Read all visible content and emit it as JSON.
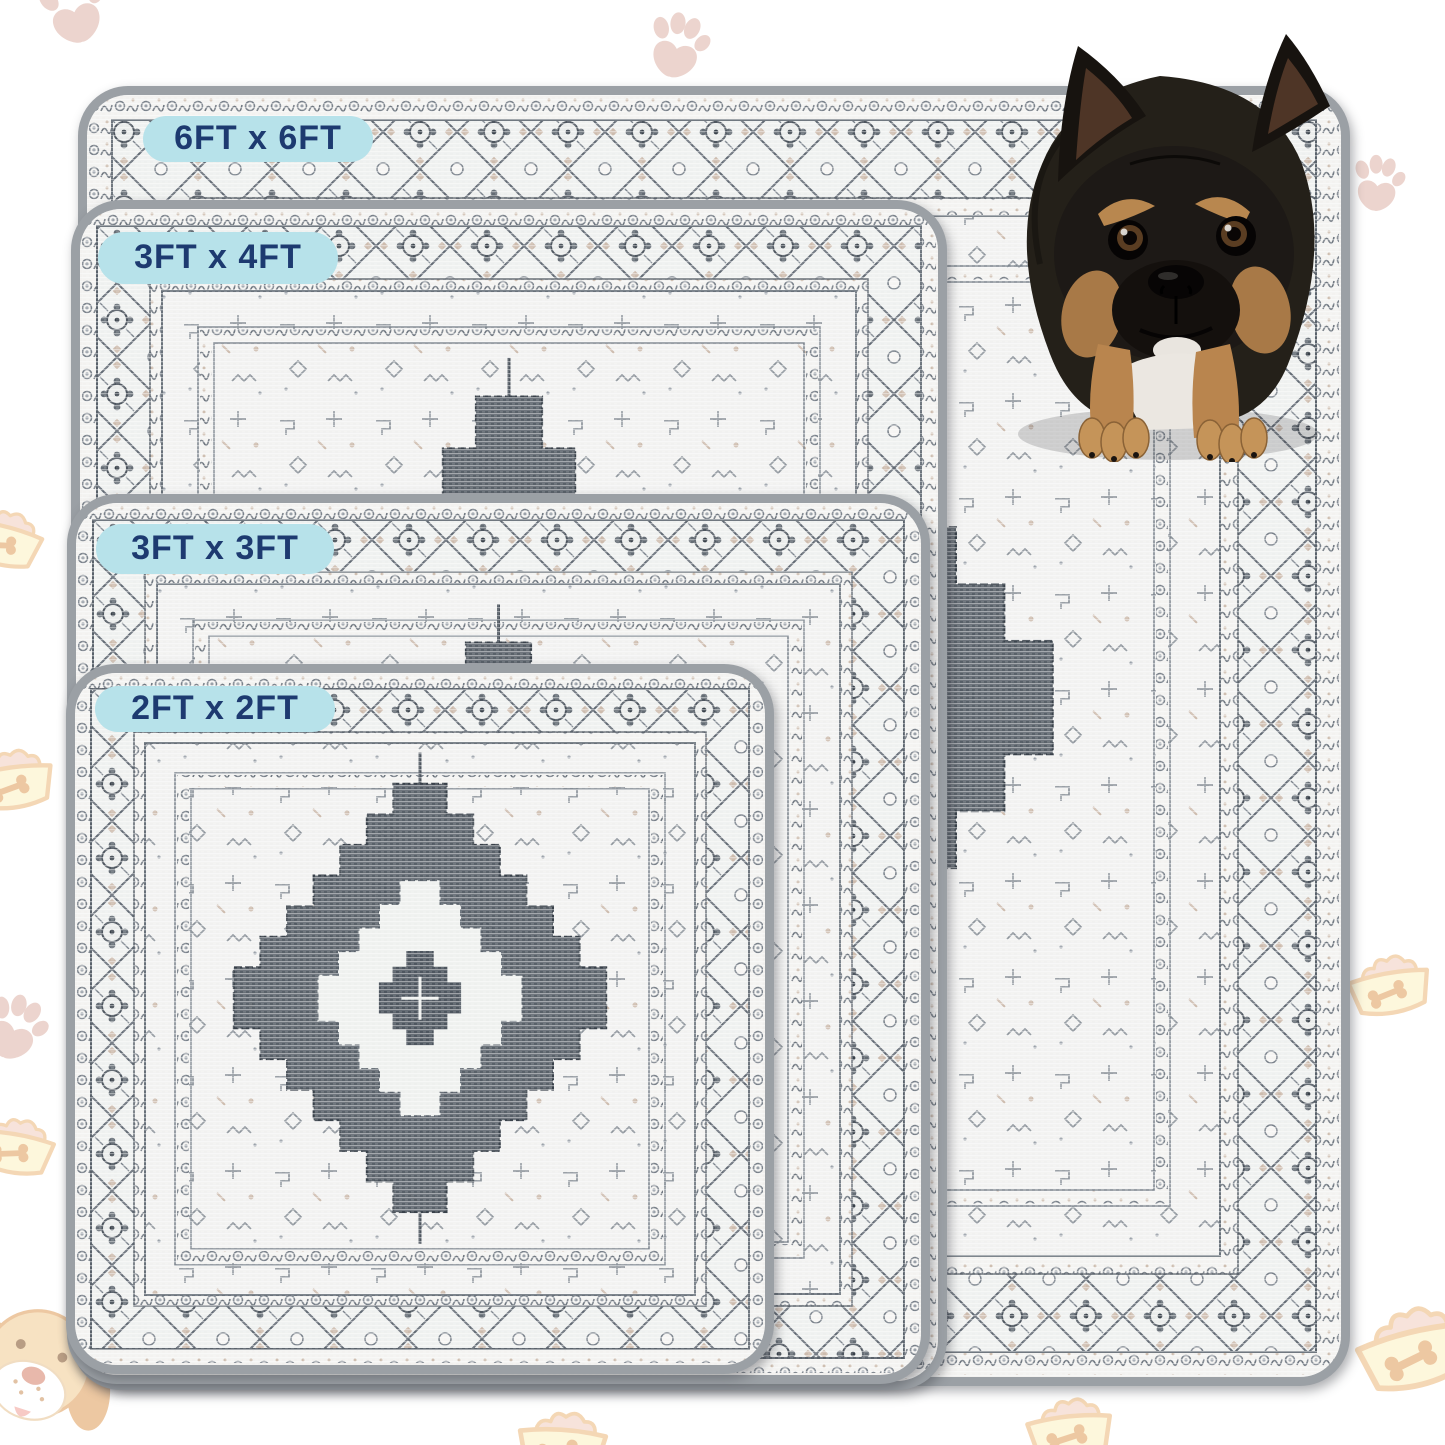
{
  "size_badges": [
    {
      "id": "6x6",
      "label": "6FT x 6FT"
    },
    {
      "id": "3x4",
      "label": "3FT x 4FT"
    },
    {
      "id": "3x3",
      "label": "3FT x 3FT"
    },
    {
      "id": "2x2",
      "label": "2FT x 2FT"
    }
  ],
  "photo": {
    "subject": "french-bulldog"
  },
  "decor_icons": [
    "paw-print-icon",
    "food-bowl-icon",
    "dog-face-icon"
  ],
  "colors": {
    "badge_bg": "#b7e2ea",
    "badge_text": "#1d3a70",
    "rug_binding": "#9ba0a5",
    "rug_field": "#f1f0ee",
    "pattern_dark": "#4e565f",
    "pattern_mid": "#7b838c",
    "pattern_tan": "#c9b9ab",
    "decor_pink": "#e0b9ae",
    "decor_yellow": "#fdf2c6",
    "decor_orange": "#edbd85"
  }
}
